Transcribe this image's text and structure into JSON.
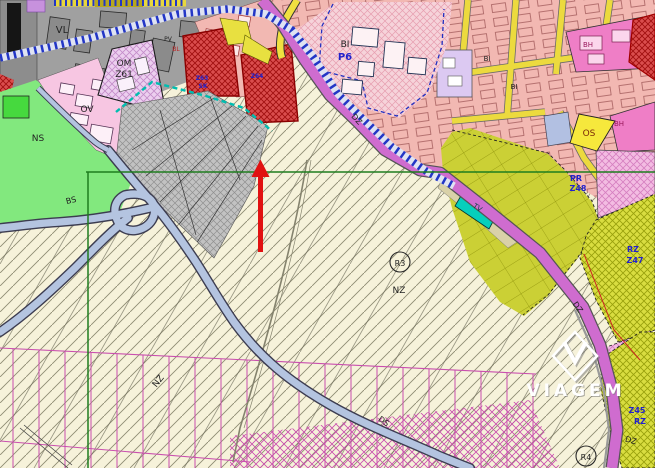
{
  "map": {
    "kind": "urban-zoning-plan",
    "watermark": {
      "name": "VIAGEM"
    },
    "labels": {
      "vl": "VL",
      "ov": "OV",
      "om": "OM",
      "z61": "Z61",
      "ns": "NS",
      "bs": "BS",
      "bi": "BI",
      "p6": "P6",
      "dz": "DZ",
      "ds": "DS",
      "os": "OS",
      "bh": "BH",
      "pv": "PV",
      "bl": "BL",
      "pr": "PR",
      "z48": "Z48",
      "rz": "RZ",
      "z47": "Z47",
      "z45": "Z45",
      "nz": "NZ",
      "r3": "R3",
      "r4": "R4",
      "tv": "TV",
      "z63": "Z63",
      "sk": "SK",
      "z64": "Z64"
    },
    "colors": {
      "background_cream": "#f6f2da",
      "road_magenta": "#cf6ccf",
      "road_service_fill": "#b4c4e0",
      "rail_blue": "#2336c6",
      "street_yellow": "#ecda3e",
      "zone_red": "#da4d4d",
      "zone_gray": "#c2c2c2",
      "zone_pink_bi": "#f6d3da",
      "zone_olive": "#cbd035",
      "zone_green_ns": "#82e87e",
      "zone_teal_tv": "#06cfbc",
      "survey_green": "#1e7d1e",
      "parcel_magenta": "#c94fae",
      "arrow_red": "#e11111"
    }
  }
}
